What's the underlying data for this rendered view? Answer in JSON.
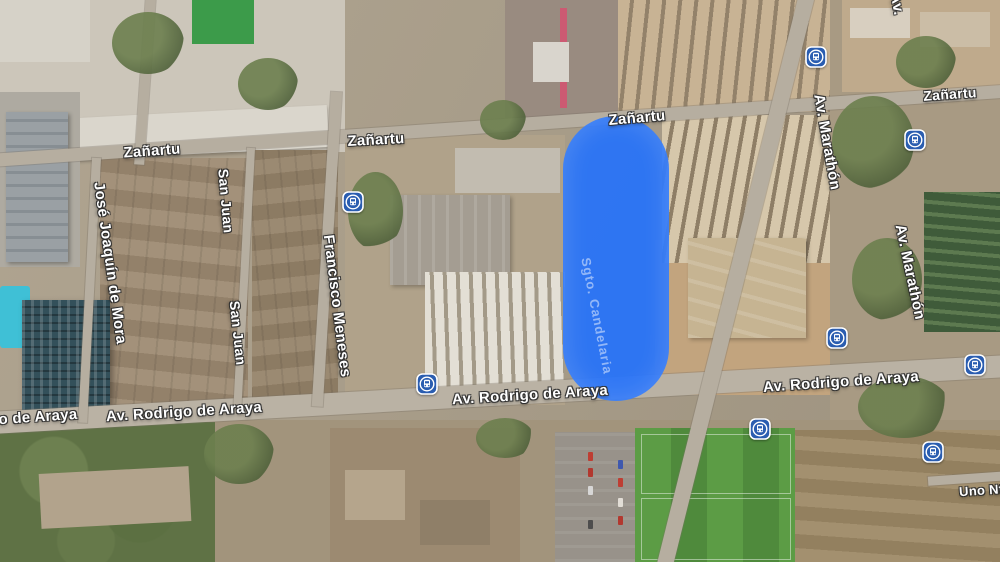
{
  "map": {
    "view_type": "satellite",
    "colors": {
      "overlay_blue": "#2673fb",
      "bus_icon_blue": "#2a5db0",
      "label_text": "#ffffff"
    },
    "overlay": {
      "label": "Sgto. Candelaria"
    },
    "street_labels": [
      {
        "text": "Zañartu",
        "x": 152,
        "y": 151,
        "rot": -4,
        "size": 15
      },
      {
        "text": "Zañartu",
        "x": 376,
        "y": 140,
        "rot": -3,
        "size": 15
      },
      {
        "text": "Zañartu",
        "x": 637,
        "y": 118,
        "rot": -5,
        "size": 15
      },
      {
        "text": "Zañartu",
        "x": 950,
        "y": 94,
        "rot": -4,
        "size": 14
      },
      {
        "text": "José Joaquín de Mora",
        "x": 110,
        "y": 263,
        "rot": 82,
        "size": 15
      },
      {
        "text": "San Juan",
        "x": 226,
        "y": 201,
        "rot": 85,
        "size": 14
      },
      {
        "text": "San Juan",
        "x": 238,
        "y": 333,
        "rot": 84,
        "size": 14
      },
      {
        "text": "Francisco Meneses",
        "x": 337,
        "y": 306,
        "rot": 83,
        "size": 15
      },
      {
        "text": "Av. Marathón",
        "x": 827,
        "y": 142,
        "rot": 80,
        "size": 15
      },
      {
        "text": "Av. Marathón",
        "x": 910,
        "y": 272,
        "rot": 78,
        "size": 15
      },
      {
        "text": "Av.",
        "x": 897,
        "y": 4,
        "rot": 80,
        "size": 15
      },
      {
        "text": "o de Araya",
        "x": 38,
        "y": 417,
        "rot": -4,
        "size": 15
      },
      {
        "text": "Av. Rodrigo de Araya",
        "x": 184,
        "y": 412,
        "rot": -3.5,
        "size": 15
      },
      {
        "text": "Av. Rodrigo de Araya",
        "x": 530,
        "y": 395,
        "rot": -3.5,
        "size": 15
      },
      {
        "text": "Av. Rodrigo de Araya",
        "x": 841,
        "y": 382,
        "rot": -4,
        "size": 15
      },
      {
        "text": "Uno Nte",
        "x": 985,
        "y": 490,
        "rot": -4,
        "size": 13
      }
    ],
    "bus_stops": [
      {
        "x": 353,
        "y": 202
      },
      {
        "x": 427,
        "y": 384
      },
      {
        "x": 816,
        "y": 57
      },
      {
        "x": 915,
        "y": 140
      },
      {
        "x": 837,
        "y": 338
      },
      {
        "x": 975,
        "y": 365
      },
      {
        "x": 760,
        "y": 429
      },
      {
        "x": 933,
        "y": 452
      }
    ]
  }
}
